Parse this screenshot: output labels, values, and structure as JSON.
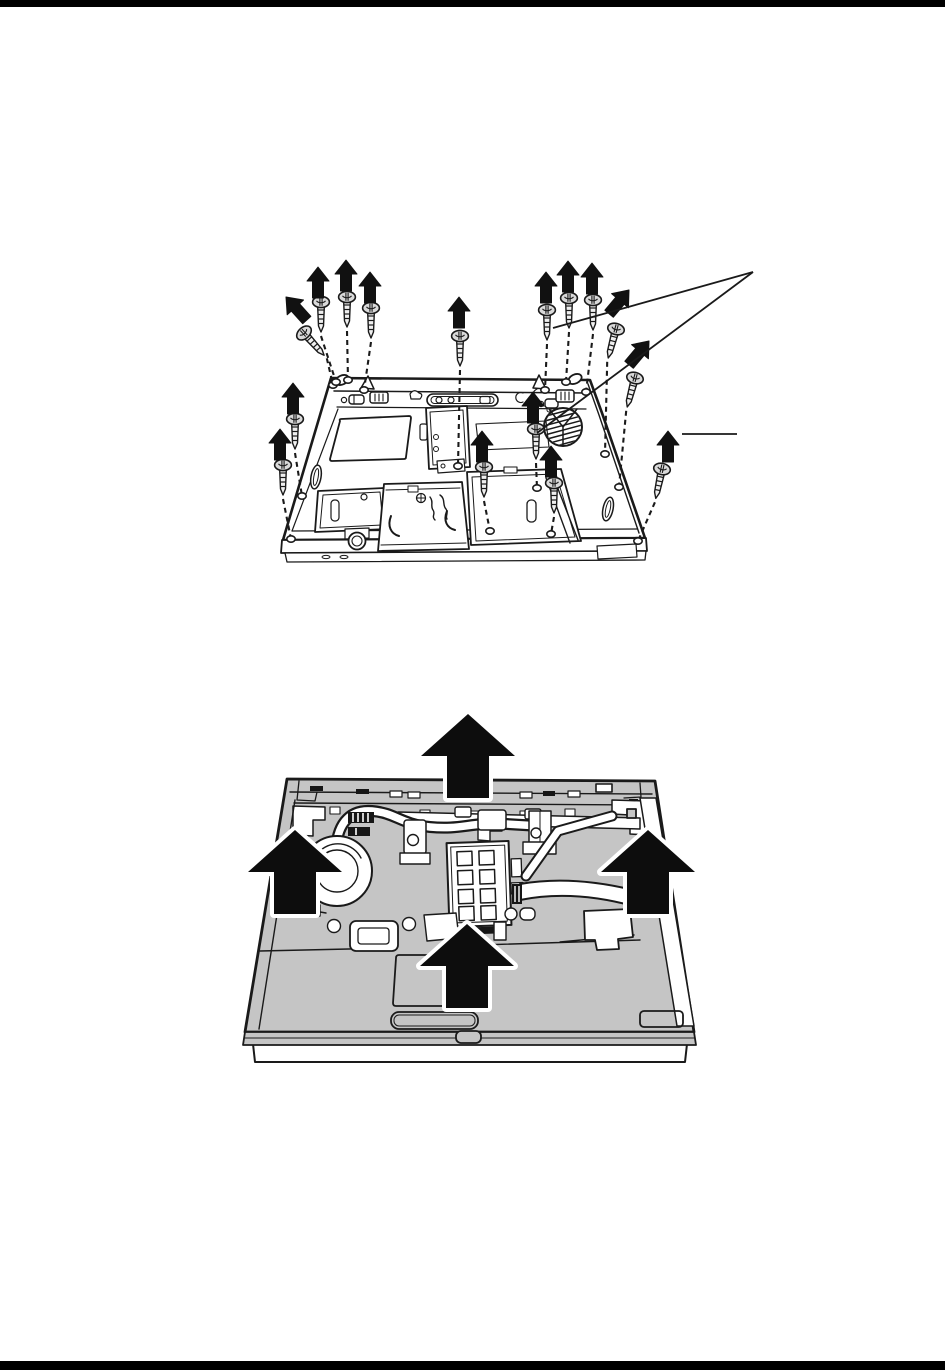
{
  "page": {
    "width": 945,
    "height": 1370,
    "background": "#ffffff",
    "top_rule": {
      "color": "#000000",
      "height": 7
    },
    "bottom_rule": {
      "color": "#000000",
      "height": 9
    }
  },
  "palette": {
    "ink": "#1a1a1a",
    "paper": "#ffffff",
    "cover_gray": "#c5c5c5",
    "screw_head_gray": "#d9d9d9"
  },
  "figure1": {
    "name": "laptop-bottom-screw-removal",
    "description": "Bottom view of a laptop base; flat-head screws lifted out with black removal arrows and dashed guide lines to their holes; two callout lines converge at upper right and a short callout tick at right",
    "screw_count": 16,
    "screws": [
      {
        "s": [
          304,
          333
        ],
        "r": -42,
        "a": [
          286,
          297
        ],
        "ar": -42,
        "h": [
          333,
          385
        ]
      },
      {
        "s": [
          321,
          302
        ],
        "r": 0,
        "a": [
          318,
          267
        ],
        "ar": 0,
        "h": [
          336,
          382
        ]
      },
      {
        "s": [
          347,
          297
        ],
        "r": 0,
        "a": [
          346,
          260
        ],
        "ar": 0,
        "h": [
          348,
          380
        ]
      },
      {
        "s": [
          371,
          308
        ],
        "r": 0,
        "a": [
          370,
          272
        ],
        "ar": 0,
        "h": [
          364,
          390
        ]
      },
      {
        "s": [
          460,
          336
        ],
        "r": 0,
        "a": [
          459,
          297
        ],
        "ar": 0,
        "h": [
          458,
          466
        ]
      },
      {
        "s": [
          547,
          310
        ],
        "r": 0,
        "a": [
          546,
          272
        ],
        "ar": 0,
        "h": [
          545,
          390
        ]
      },
      {
        "s": [
          569,
          298
        ],
        "r": 0,
        "a": [
          568,
          261
        ],
        "ar": 0,
        "h": [
          566,
          382
        ]
      },
      {
        "s": [
          593,
          300
        ],
        "r": 0,
        "a": [
          592,
          263
        ],
        "ar": 0,
        "h": [
          586,
          392
        ]
      },
      {
        "s": [
          616,
          329
        ],
        "r": 15,
        "a": [
          629,
          290
        ],
        "ar": 40,
        "h": [
          605,
          454
        ]
      },
      {
        "s": [
          635,
          378
        ],
        "r": 15,
        "a": [
          649,
          341
        ],
        "ar": 40,
        "h": [
          619,
          487
        ]
      },
      {
        "s": [
          295,
          419
        ],
        "r": 0,
        "a": [
          293,
          383
        ],
        "ar": 0,
        "h": [
          302,
          496
        ]
      },
      {
        "s": [
          283,
          465
        ],
        "r": 0,
        "a": [
          280,
          429
        ],
        "ar": 0,
        "h": [
          291,
          539
        ]
      },
      {
        "s": [
          484,
          467
        ],
        "r": 0,
        "a": [
          482,
          431
        ],
        "ar": 0,
        "h": [
          490,
          531
        ]
      },
      {
        "s": [
          536,
          429
        ],
        "r": 0,
        "a": [
          533,
          392
        ],
        "ar": 0,
        "h": [
          537,
          488
        ]
      },
      {
        "s": [
          554,
          483
        ],
        "r": 0,
        "a": [
          551,
          446
        ],
        "ar": 0,
        "h": [
          551,
          534
        ]
      },
      {
        "s": [
          662,
          469
        ],
        "r": 12,
        "a": [
          668,
          431
        ],
        "ar": 0,
        "h": [
          638,
          541
        ]
      }
    ],
    "callout": {
      "apex": [
        753,
        272
      ],
      "targets": [
        [
          553,
          328
        ],
        [
          537,
          433
        ]
      ],
      "tick": [
        682,
        434,
        737,
        434
      ]
    }
  },
  "figure2": {
    "name": "top-cover-lift-off",
    "description": "Top view of laptop with top cover removed showing fan, heat pipe, memory module and flat cable; four large outlined arrows indicate lifting the cover",
    "arrow_count": 4,
    "arrows": [
      {
        "tip": [
          468,
          714
        ]
      },
      {
        "tip": [
          295,
          830
        ]
      },
      {
        "tip": [
          648,
          830
        ]
      },
      {
        "tip": [
          467,
          924
        ]
      }
    ]
  }
}
